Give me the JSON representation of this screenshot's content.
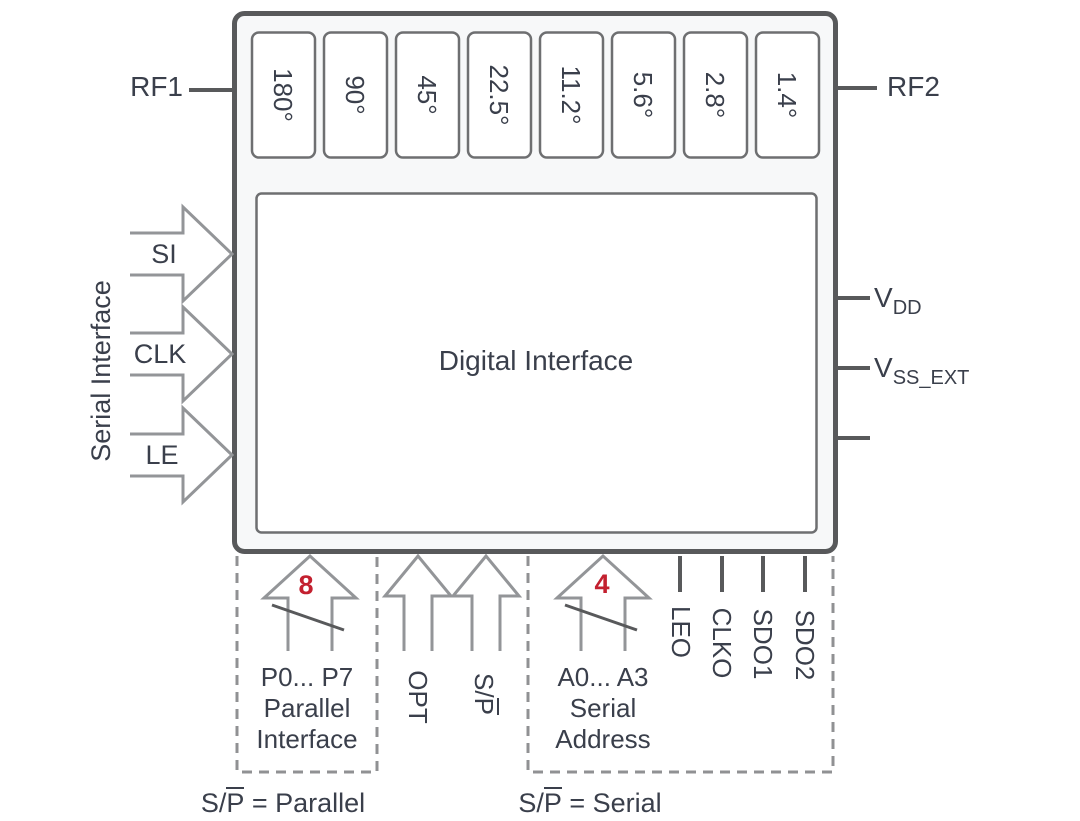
{
  "chip": {
    "digital_interface": "Digital Interface",
    "phase_shifters": [
      "180°",
      "90°",
      "45°",
      "22.5°",
      "11.2°",
      "5.6°",
      "2.8°",
      "1.4°"
    ]
  },
  "ports": {
    "rf1": "RF1",
    "rf2": "RF2",
    "serial_interface": "Serial Interface",
    "si": "SI",
    "clk": "CLK",
    "le": "LE",
    "vdd": {
      "base": "V",
      "sub": "DD"
    },
    "vss": {
      "base": "V",
      "sub": "SS_EXT"
    }
  },
  "bottom": {
    "parallel": {
      "bus_width": "8",
      "pins": "P0... P7",
      "label_line1": "Parallel",
      "label_line2": "Interface",
      "caption": {
        "s": "S/",
        "p": "P",
        "rest": " = Parallel"
      }
    },
    "opt": "OPT",
    "sp": {
      "s": "S/",
      "p": "P"
    },
    "serial": {
      "bus_width": "4",
      "pins": "A0... A3",
      "label_line1": "Serial",
      "label_line2": "Address",
      "caption": {
        "s": "S/",
        "p": "P",
        "rest": " = Serial"
      }
    },
    "outputs": [
      "LEO",
      "CLKO",
      "SDO1",
      "SDO2"
    ]
  },
  "colors": {
    "accent_red": "#c3202f",
    "line_dark": "#58595b",
    "line_gray": "#939598",
    "text": "#3a3f4b"
  }
}
